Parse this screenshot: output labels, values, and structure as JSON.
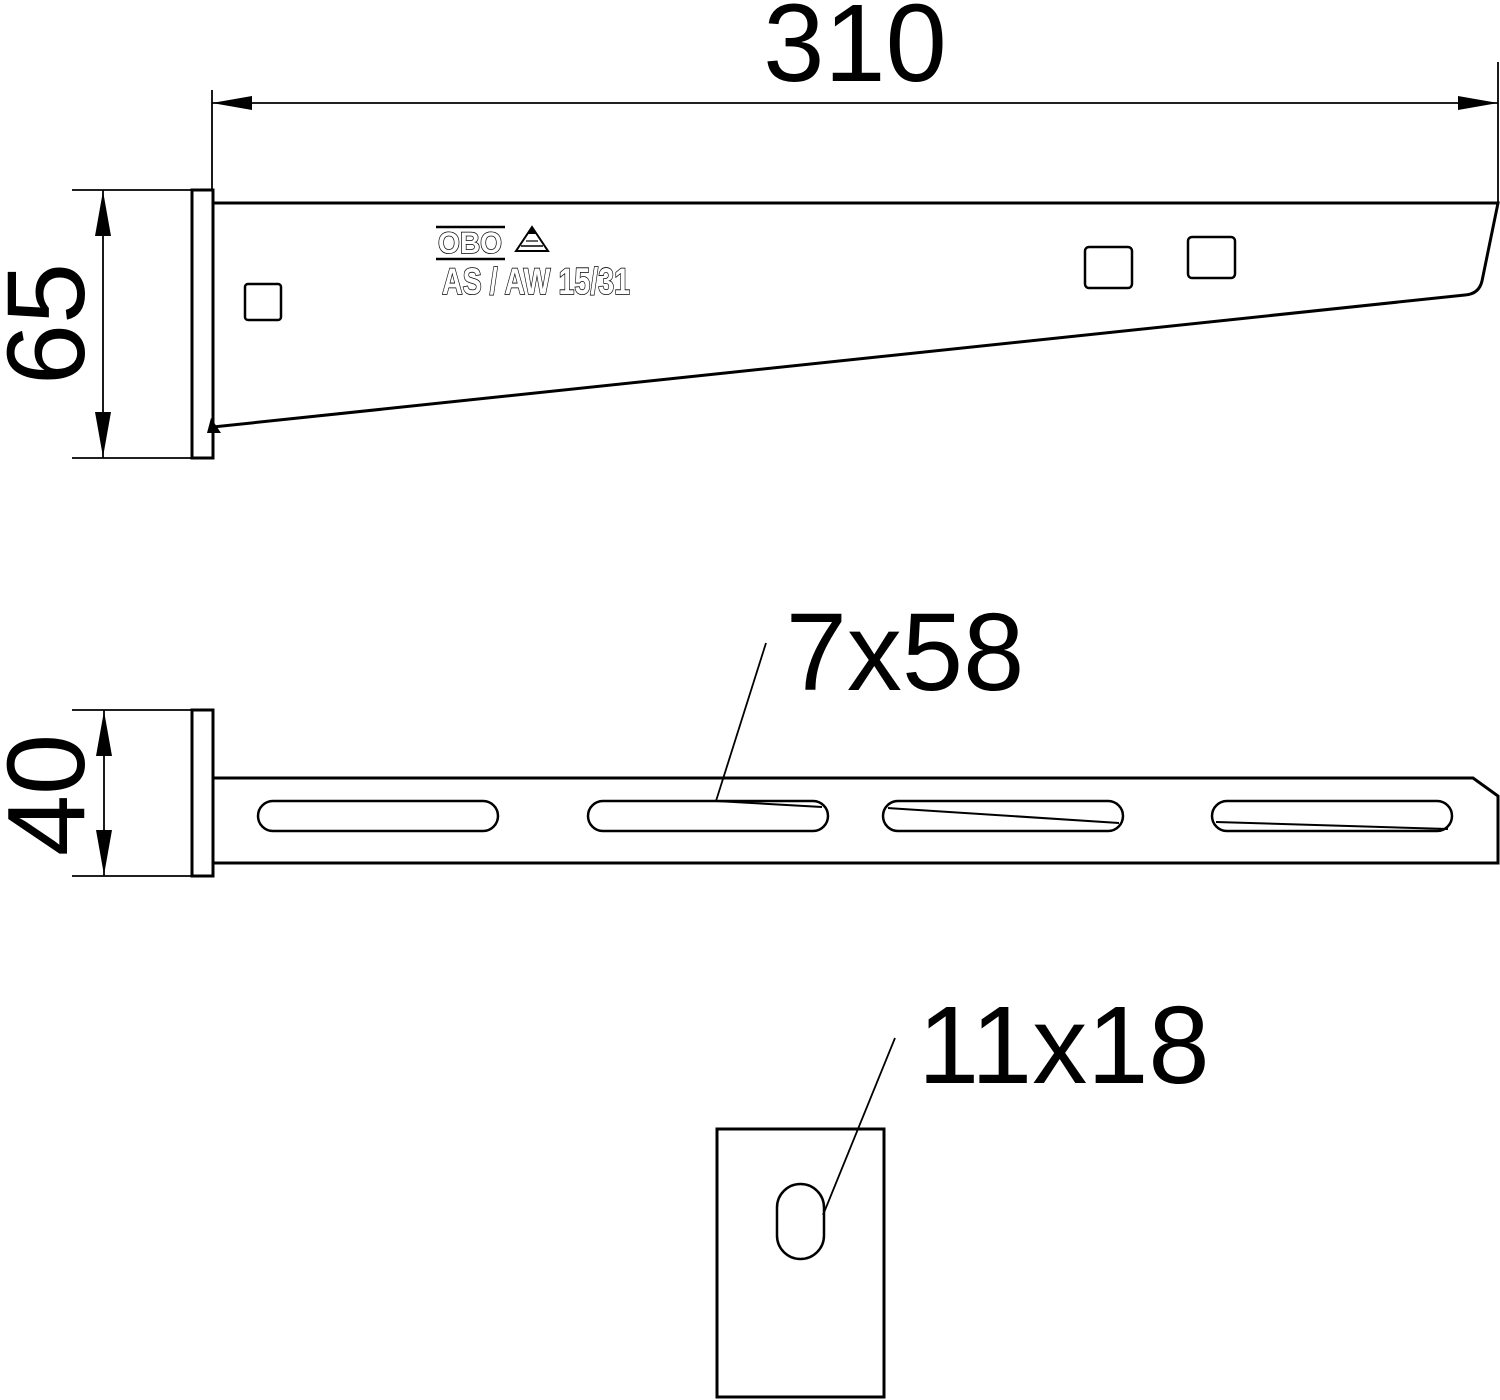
{
  "page": {
    "background": "#ffffff",
    "line_color": "#000000"
  },
  "side_view": {
    "length_label": "310",
    "height_label": "65",
    "brand": "OBO",
    "product_code": "AS / AW 15/31"
  },
  "plan_view": {
    "width_label": "40",
    "slot_label": "7x58"
  },
  "front_view": {
    "hole_label": "11x18"
  }
}
